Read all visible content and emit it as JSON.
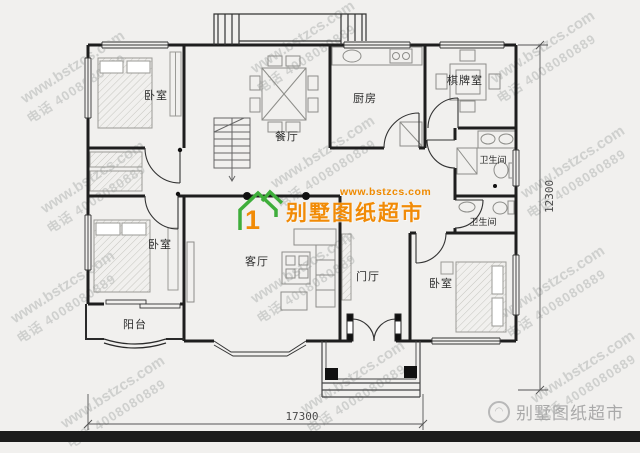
{
  "watermark": {
    "line1": "www.bstzcs.com",
    "line2": "电话 4008080889"
  },
  "logo": {
    "site": "www.bstzcs.com",
    "name": "别墅图纸超市"
  },
  "brand_watermark": {
    "name": "别墅图纸超市"
  },
  "plan": {
    "rooms": [
      {
        "id": "bedroom-1",
        "label": "卧室"
      },
      {
        "id": "dining-room",
        "label": "餐厅"
      },
      {
        "id": "kitchen",
        "label": "厨房"
      },
      {
        "id": "mahjong-room",
        "label": "棋牌室"
      },
      {
        "id": "bathroom-1",
        "label": "卫生间"
      },
      {
        "id": "bathroom-2",
        "label": "卫生间"
      },
      {
        "id": "bedroom-2",
        "label": "卧室"
      },
      {
        "id": "living-room",
        "label": "客厅"
      },
      {
        "id": "foyer",
        "label": "门厅"
      },
      {
        "id": "bedroom-3",
        "label": "卧室"
      },
      {
        "id": "balcony",
        "label": "阳台"
      }
    ],
    "dim_width": "17300",
    "dim_height": "12300"
  },
  "colors": {
    "background": "#f1f0ee",
    "wall": "#1e1e1e",
    "logo_green": "#3fae3b",
    "logo_orange": "#f18b07",
    "footer_bar": "#1c1c1c",
    "watermark_gray": "#9aa0a0"
  }
}
